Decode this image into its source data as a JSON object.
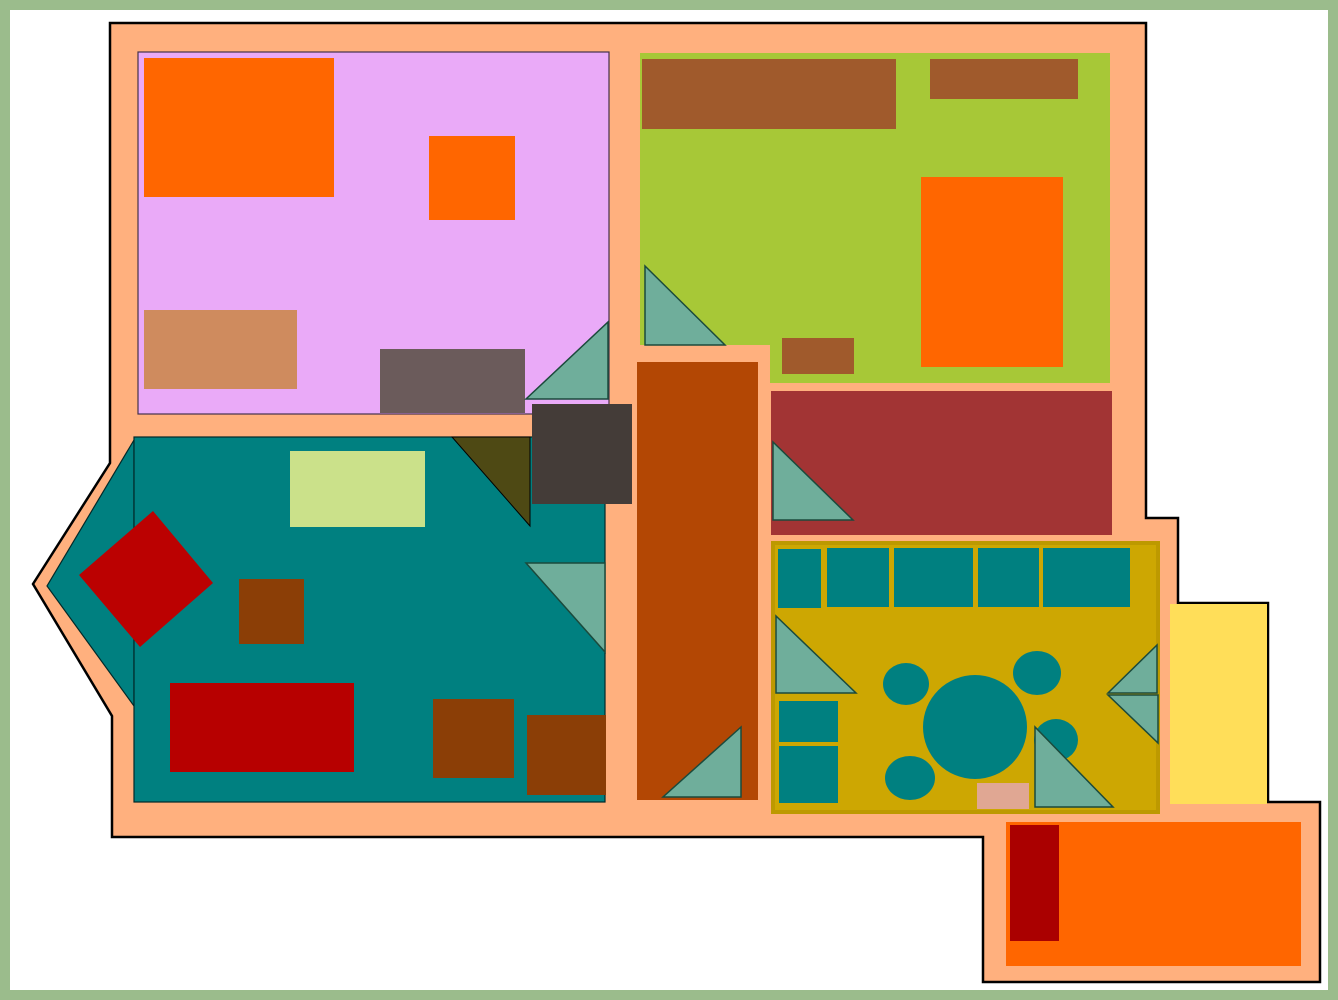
{
  "canvas": {
    "width": 1338,
    "height": 1000,
    "frame_color": "#9BBC8C",
    "background_color": "#FFFFFF",
    "wall_color": "#FFB07E",
    "outline_color": "#000000"
  },
  "shapes": [
    {
      "name": "frame-border",
      "type": "rect",
      "x": 0,
      "y": 0,
      "w": 1338,
      "h": 1000,
      "fill": "#9BBC8C"
    },
    {
      "name": "page-background",
      "type": "rect",
      "x": 10,
      "y": 10,
      "w": 1318,
      "h": 980,
      "fill": "#FFFFFF"
    },
    {
      "name": "house-wall-outline",
      "type": "polygon",
      "points": "110,23 1146,23 1146,518 1178,518 1178,603 1268,603 1268,802 1320,802 1320,982 983,982 983,837 112,837 112,716 33,584 110,463",
      "fill": "#FFB07E",
      "stroke": "#000000",
      "sw": 2.5
    },
    {
      "name": "lavender-room",
      "type": "rect",
      "x": 138,
      "y": 52,
      "w": 471,
      "h": 362,
      "fill": "#EAAAF8",
      "stroke": "#43314B",
      "sw": 1.2
    },
    {
      "name": "green-room",
      "type": "polygon",
      "points": "640,53 1110,53 1110,383 770,383 770,345 640,345",
      "fill": "#A7C837"
    },
    {
      "name": "teal-room-bay",
      "type": "polygon",
      "points": "134,440 47,586 134,706",
      "fill": "#008080",
      "stroke": "#002929",
      "sw": 1.2
    },
    {
      "name": "teal-room",
      "type": "rect",
      "x": 134,
      "y": 437,
      "w": 471,
      "h": 365,
      "fill": "#008080",
      "stroke": "#002929",
      "sw": 1.2
    },
    {
      "name": "hallway-corridor",
      "type": "rect",
      "x": 637,
      "y": 362,
      "w": 121,
      "h": 438,
      "fill": "#B34704"
    },
    {
      "name": "brick-red-room",
      "type": "rect",
      "x": 771,
      "y": 391,
      "w": 341,
      "h": 144,
      "fill": "#A23434"
    },
    {
      "name": "dining-room",
      "type": "rect",
      "x": 773,
      "y": 543,
      "w": 385,
      "h": 269,
      "fill": "#CDA702",
      "stroke": "#BD9900",
      "sw": 4
    },
    {
      "name": "orange-room",
      "type": "rect",
      "x": 1006,
      "y": 822,
      "w": 295,
      "h": 144,
      "fill": "#FF6600"
    },
    {
      "name": "yellow-annex",
      "type": "rect",
      "x": 1170,
      "y": 604,
      "w": 97,
      "h": 200,
      "fill": "#FFDE59"
    },
    {
      "name": "orange-bed",
      "type": "rect",
      "x": 144,
      "y": 58,
      "w": 190,
      "h": 139,
      "fill": "#FF6600"
    },
    {
      "name": "orange-side-table",
      "type": "rect",
      "x": 429,
      "y": 136,
      "w": 86,
      "h": 84,
      "fill": "#FF6600"
    },
    {
      "name": "tan-rug",
      "type": "rect",
      "x": 144,
      "y": 310,
      "w": 153,
      "h": 79,
      "fill": "#CF8B5E"
    },
    {
      "name": "gray-dresser",
      "type": "rect",
      "x": 380,
      "y": 349,
      "w": 145,
      "h": 64,
      "fill": "#6B5B5B"
    },
    {
      "name": "lavender-room-door",
      "type": "polygon",
      "points": "608,322 608,399 526,399",
      "fill": "#6FAE9B",
      "stroke": "#1B4A3C",
      "sw": 1.5
    },
    {
      "name": "brown-wardrobe",
      "type": "rect",
      "x": 642,
      "y": 59,
      "w": 254,
      "h": 70,
      "fill": "#A05A2C"
    },
    {
      "name": "brown-shelf",
      "type": "rect",
      "x": 930,
      "y": 59,
      "w": 148,
      "h": 40,
      "fill": "#A05A2C"
    },
    {
      "name": "orange-bed-2",
      "type": "rect",
      "x": 921,
      "y": 177,
      "w": 142,
      "h": 190,
      "fill": "#FF6600"
    },
    {
      "name": "green-room-door",
      "type": "polygon",
      "points": "645,266 645,345 725,345",
      "fill": "#6FAE9B",
      "stroke": "#1B4A3C",
      "sw": 1.5
    },
    {
      "name": "brown-stool",
      "type": "rect",
      "x": 782,
      "y": 338,
      "w": 72,
      "h": 36,
      "fill": "#A05A2C"
    },
    {
      "name": "olive-corner-wedge",
      "type": "polygon",
      "points": "452,437 530,437 530,526",
      "fill": "#4E4914",
      "stroke": "#000000",
      "sw": 1
    },
    {
      "name": "junction-block",
      "type": "rect",
      "x": 532,
      "y": 404,
      "w": 100,
      "h": 100,
      "fill": "#443C38"
    },
    {
      "name": "lightgreen-rug",
      "type": "rect",
      "x": 290,
      "y": 451,
      "w": 135,
      "h": 76,
      "fill": "#CBE18A"
    },
    {
      "name": "red-diamond-table",
      "type": "polygon",
      "points": "153,511 213,583 140,647 79,575",
      "fill": "#BB0101"
    },
    {
      "name": "brown-side-table",
      "type": "rect",
      "x": 239,
      "y": 579,
      "w": 65,
      "h": 65,
      "fill": "#8B3E06"
    },
    {
      "name": "teal-room-door",
      "type": "polygon",
      "points": "526,563 605,563 605,652",
      "fill": "#6FAE9B",
      "stroke": "#1B4A3C",
      "sw": 1.5
    },
    {
      "name": "red-rug",
      "type": "rect",
      "x": 170,
      "y": 683,
      "w": 184,
      "h": 89,
      "fill": "#B70000"
    },
    {
      "name": "brown-chest-1",
      "type": "rect",
      "x": 433,
      "y": 699,
      "w": 81,
      "h": 79,
      "fill": "#8B3E06"
    },
    {
      "name": "brown-chest-2",
      "type": "rect",
      "x": 527,
      "y": 715,
      "w": 79,
      "h": 80,
      "fill": "#8B3E06"
    },
    {
      "name": "corridor-door",
      "type": "polygon",
      "points": "663,797 741,797 741,727",
      "fill": "#6FAE9B",
      "stroke": "#1B4A3C",
      "sw": 1.5
    },
    {
      "name": "brick-room-door",
      "type": "polygon",
      "points": "773,442 773,520 853,520",
      "fill": "#6FAE9B",
      "stroke": "#1B4A3C",
      "sw": 1.5
    },
    {
      "name": "counter-1",
      "type": "rect",
      "x": 778,
      "y": 549,
      "w": 43,
      "h": 59,
      "fill": "#008080"
    },
    {
      "name": "counter-2",
      "type": "rect",
      "x": 827,
      "y": 548,
      "w": 62,
      "h": 59,
      "fill": "#008080"
    },
    {
      "name": "counter-3",
      "type": "rect",
      "x": 894,
      "y": 548,
      "w": 79,
      "h": 59,
      "fill": "#008080"
    },
    {
      "name": "counter-4",
      "type": "rect",
      "x": 978,
      "y": 548,
      "w": 61,
      "h": 59,
      "fill": "#008080"
    },
    {
      "name": "counter-5",
      "type": "rect",
      "x": 1043,
      "y": 548,
      "w": 87,
      "h": 59,
      "fill": "#008080"
    },
    {
      "name": "dining-door-left",
      "type": "polygon",
      "points": "776,616 776,693 856,693",
      "fill": "#6FAE9B",
      "stroke": "#1B4A3C",
      "sw": 1.5
    },
    {
      "name": "cabinet-1",
      "type": "rect",
      "x": 779,
      "y": 701,
      "w": 59,
      "h": 41,
      "fill": "#008080"
    },
    {
      "name": "cabinet-2",
      "type": "rect",
      "x": 779,
      "y": 746,
      "w": 59,
      "h": 57,
      "fill": "#008080"
    },
    {
      "name": "dining-table",
      "type": "circle",
      "cx": 975,
      "cy": 727,
      "r": 52,
      "fill": "#008080"
    },
    {
      "name": "chair-northwest",
      "type": "ellipse",
      "cx": 906,
      "cy": 684,
      "rx": 23,
      "ry": 21,
      "fill": "#008080"
    },
    {
      "name": "chair-northeast",
      "type": "ellipse",
      "cx": 1037,
      "cy": 673,
      "rx": 24,
      "ry": 22,
      "fill": "#008080"
    },
    {
      "name": "chair-east",
      "type": "ellipse",
      "cx": 1056,
      "cy": 740,
      "rx": 22,
      "ry": 21,
      "fill": "#008080"
    },
    {
      "name": "chair-southwest",
      "type": "ellipse",
      "cx": 910,
      "cy": 778,
      "rx": 25,
      "ry": 22,
      "fill": "#008080"
    },
    {
      "name": "pink-mat",
      "type": "rect",
      "x": 977,
      "y": 783,
      "w": 52,
      "h": 26,
      "fill": "#E0A793"
    },
    {
      "name": "dining-door-bottom",
      "type": "polygon",
      "points": "1035,727 1035,807 1113,807",
      "fill": "#6FAE9B",
      "stroke": "#1B4A3C",
      "sw": 1.5
    },
    {
      "name": "dining-door-right-upper",
      "type": "polygon",
      "points": "1108,693 1157,693 1157,645",
      "fill": "#6FAE9B",
      "stroke": "#1B4A3C",
      "sw": 1.5
    },
    {
      "name": "dining-door-right-lower",
      "type": "polygon",
      "points": "1108,695 1158,695 1158,743",
      "fill": "#6FAE9B",
      "stroke": "#1B4A3C",
      "sw": 1.5
    },
    {
      "name": "red-runner",
      "type": "rect",
      "x": 1010,
      "y": 825,
      "w": 49,
      "h": 116,
      "fill": "#AA0000"
    }
  ]
}
